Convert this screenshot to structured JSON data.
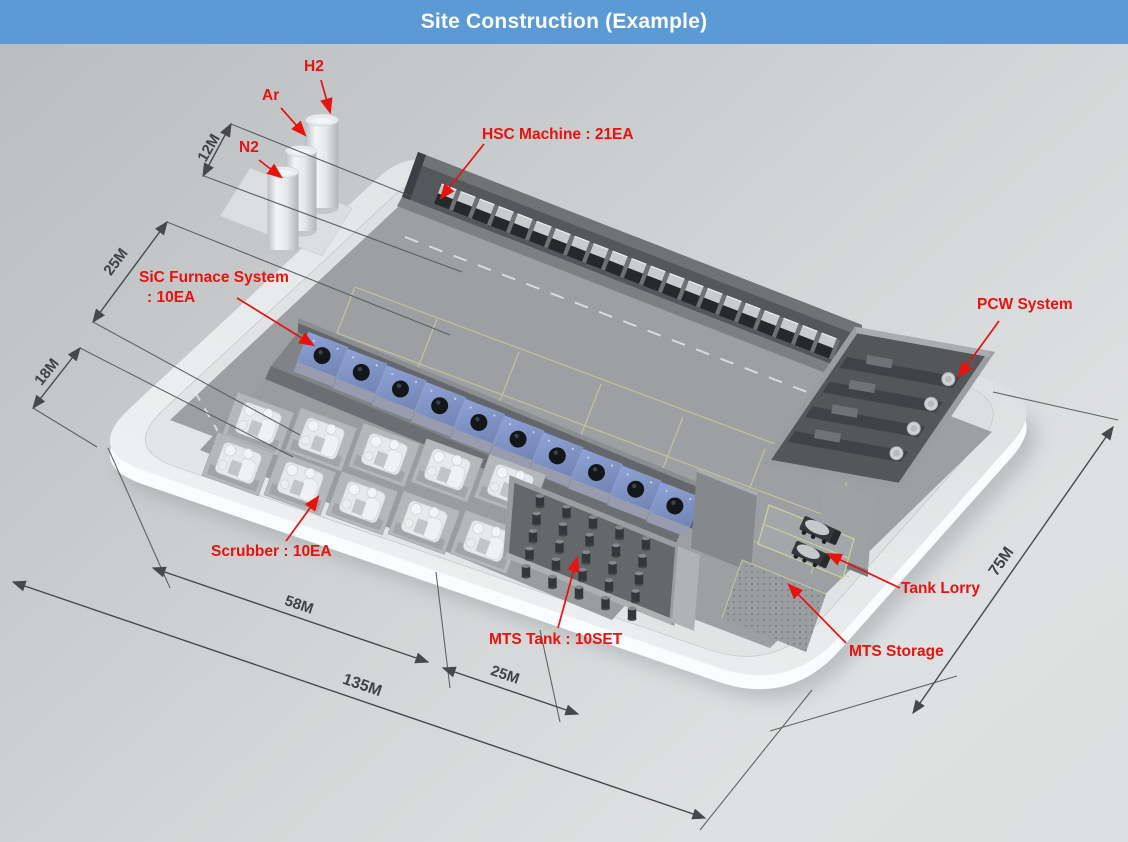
{
  "header": {
    "title": "Site Construction (Example)"
  },
  "colors": {
    "header_bg": "#5b9ad5",
    "annotation_red": "#e8120e",
    "dimension_text": "#3f4346",
    "furnace_blue": "#8195c9",
    "platform": "#eceeef"
  },
  "annotations": {
    "h2": "H2",
    "ar": "Ar",
    "n2": "N2",
    "hsc": "HSC Machine : 21EA",
    "sic_line1": "SiC Furnace System",
    "sic_line2": ": 10EA",
    "pcw": "PCW System",
    "scrubber": "Scrubber : 10EA",
    "mts_tank": "MTS Tank : 10SET",
    "tank_lorry": "Tank Lorry",
    "mts_storage": "MTS Storage"
  },
  "dimensions": {
    "gas_yard": "12M",
    "hsc_zone": "25M",
    "furnace_zone": "18M",
    "scrubber_span": "58M",
    "site_length": "135M",
    "mts_span": "25M",
    "site_width": "75M"
  },
  "equipment": {
    "hsc_machine_count": 21,
    "sic_furnace_count": 10,
    "scrubber_count": 10,
    "mts_tank_sets": 10,
    "gas_tanks": [
      "N2",
      "Ar",
      "H2"
    ]
  }
}
